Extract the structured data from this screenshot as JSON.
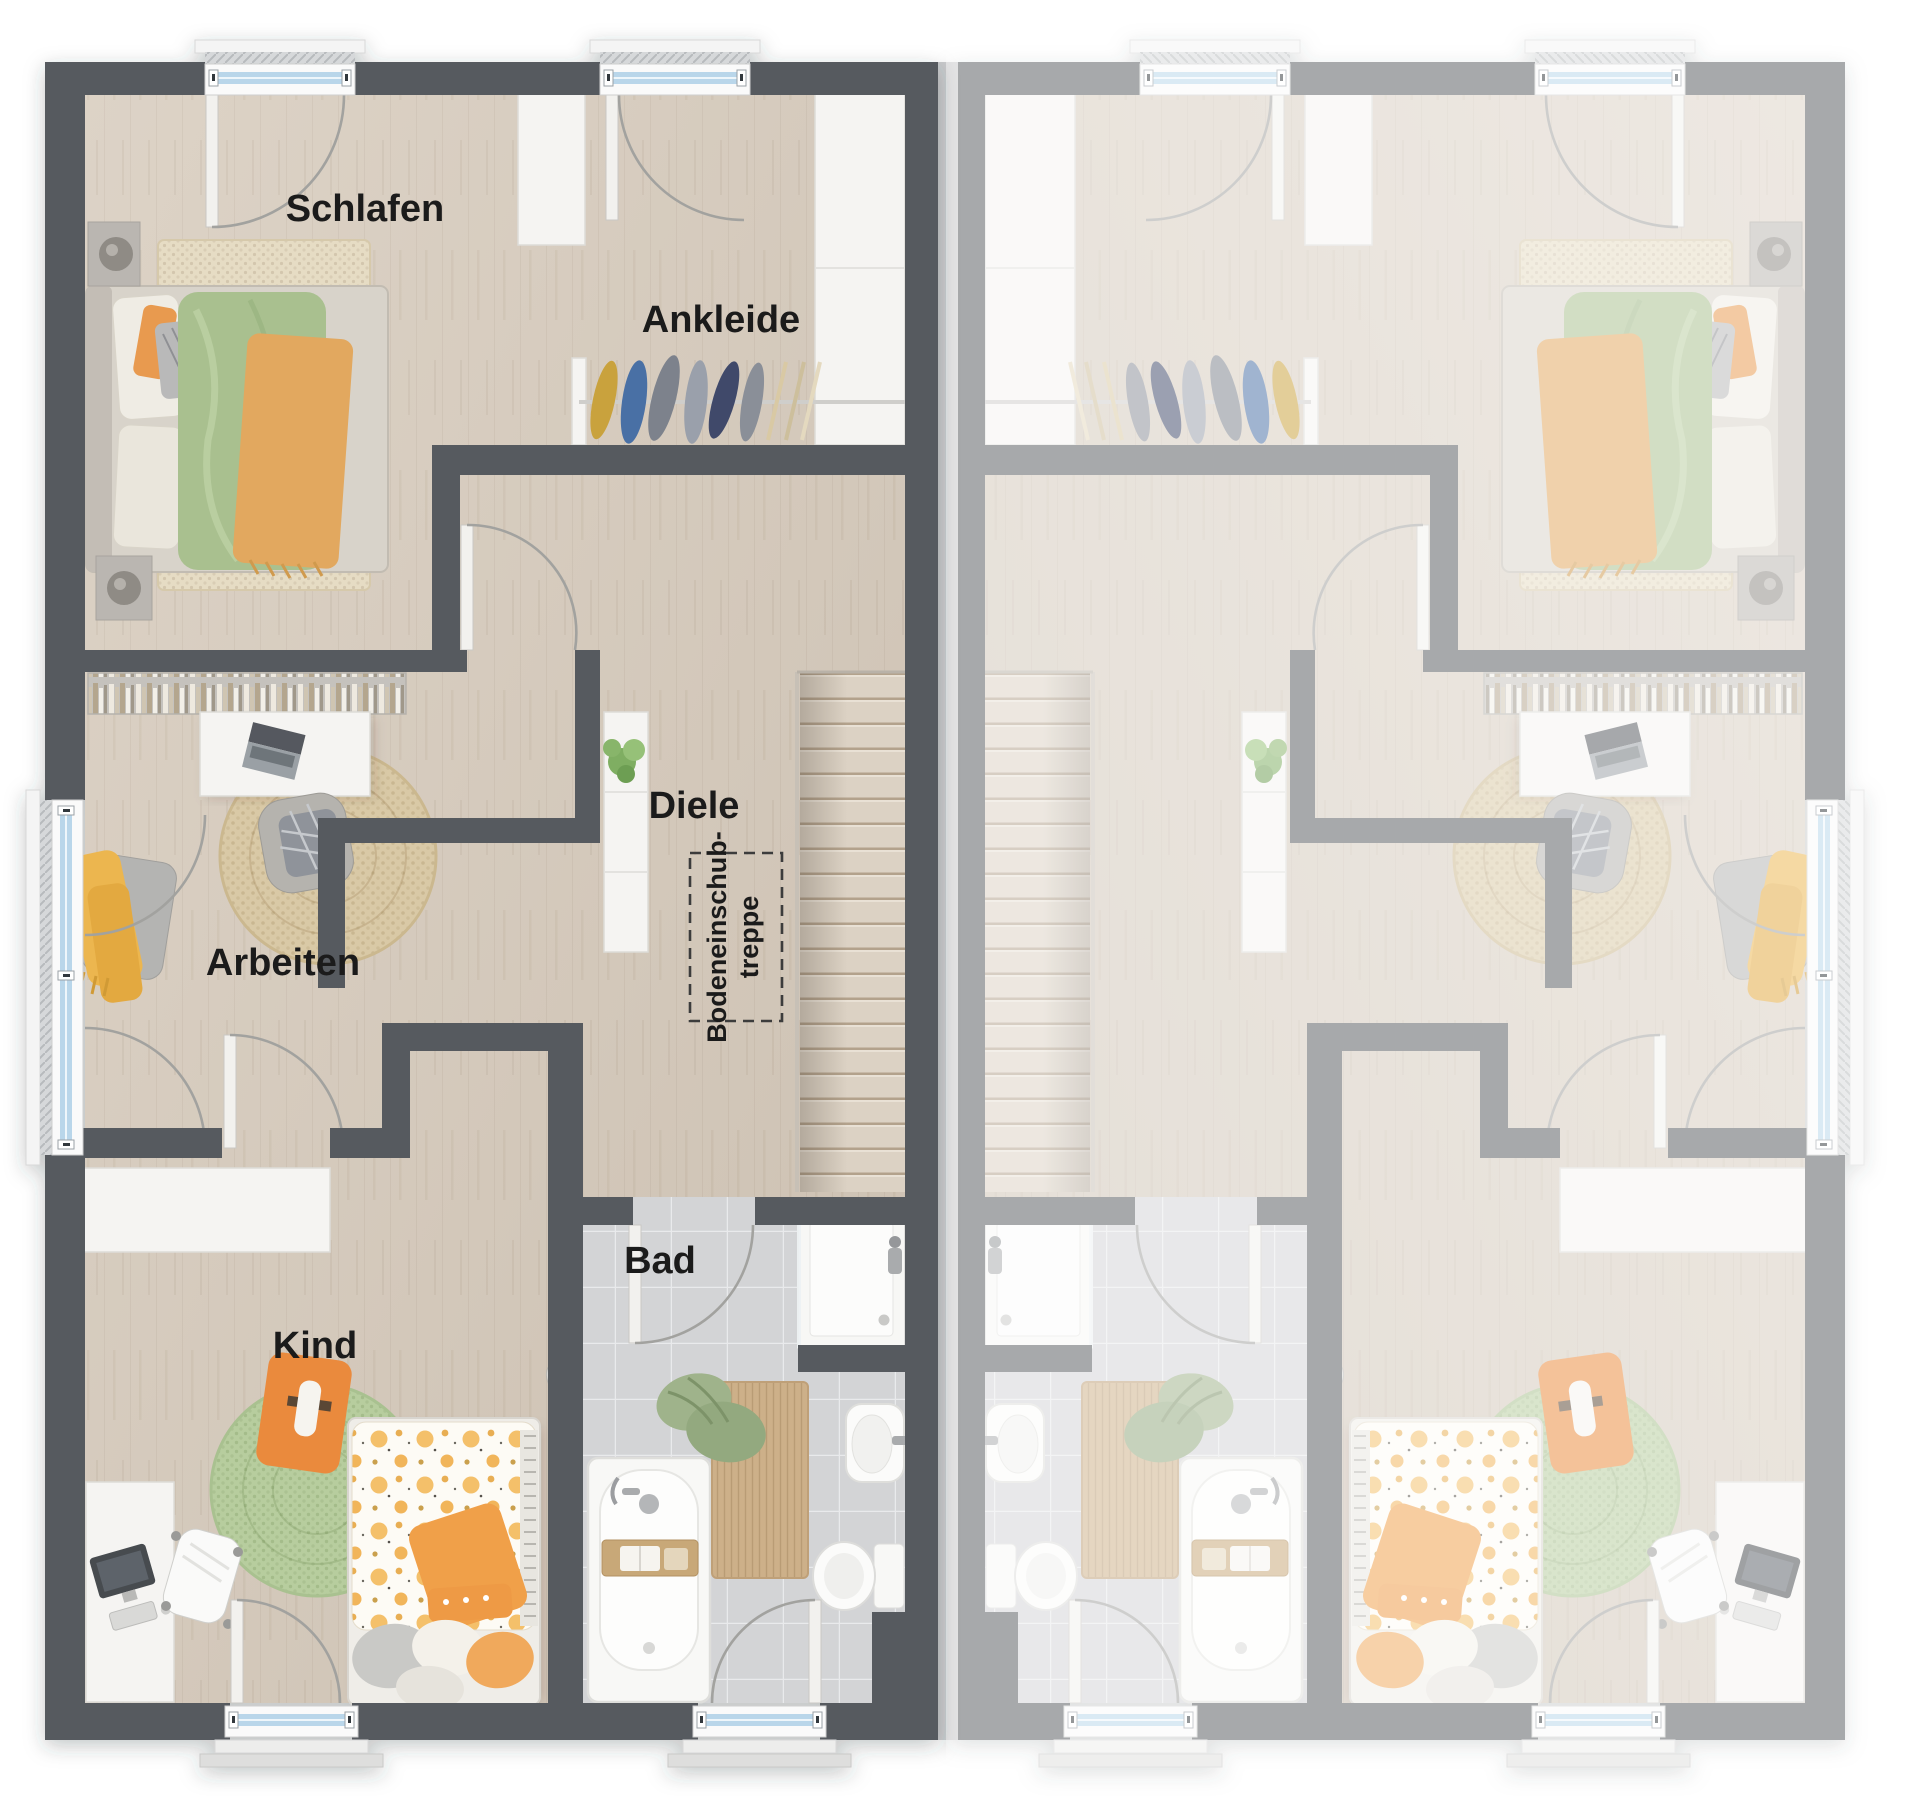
{
  "title": "Obergeschoss Grundriss Doppelhaus",
  "colors": {
    "wall": "#575a5f",
    "floor": "#d9cec0",
    "tile": "#d3d4d6",
    "label": "#1b1b1b",
    "accent_green": "#a9c08f",
    "accent_orange": "#e8a857",
    "kid_orange": "#ea8a3e",
    "glazing_blue": "#b9d6ea",
    "rug_jute": "#d9c9a6",
    "rug_green": "#b7cd9e",
    "fade_overlay": "#ffffff"
  },
  "rooms": {
    "schlafen": "Schlafen",
    "ankleide": "Ankleide",
    "diele": "Diele",
    "arbeiten": "Arbeiten",
    "kind": "Kind",
    "bad": "Bad"
  },
  "annotations": {
    "attic_line1": "Bodeneinschub-",
    "attic_line2": "treppe"
  }
}
